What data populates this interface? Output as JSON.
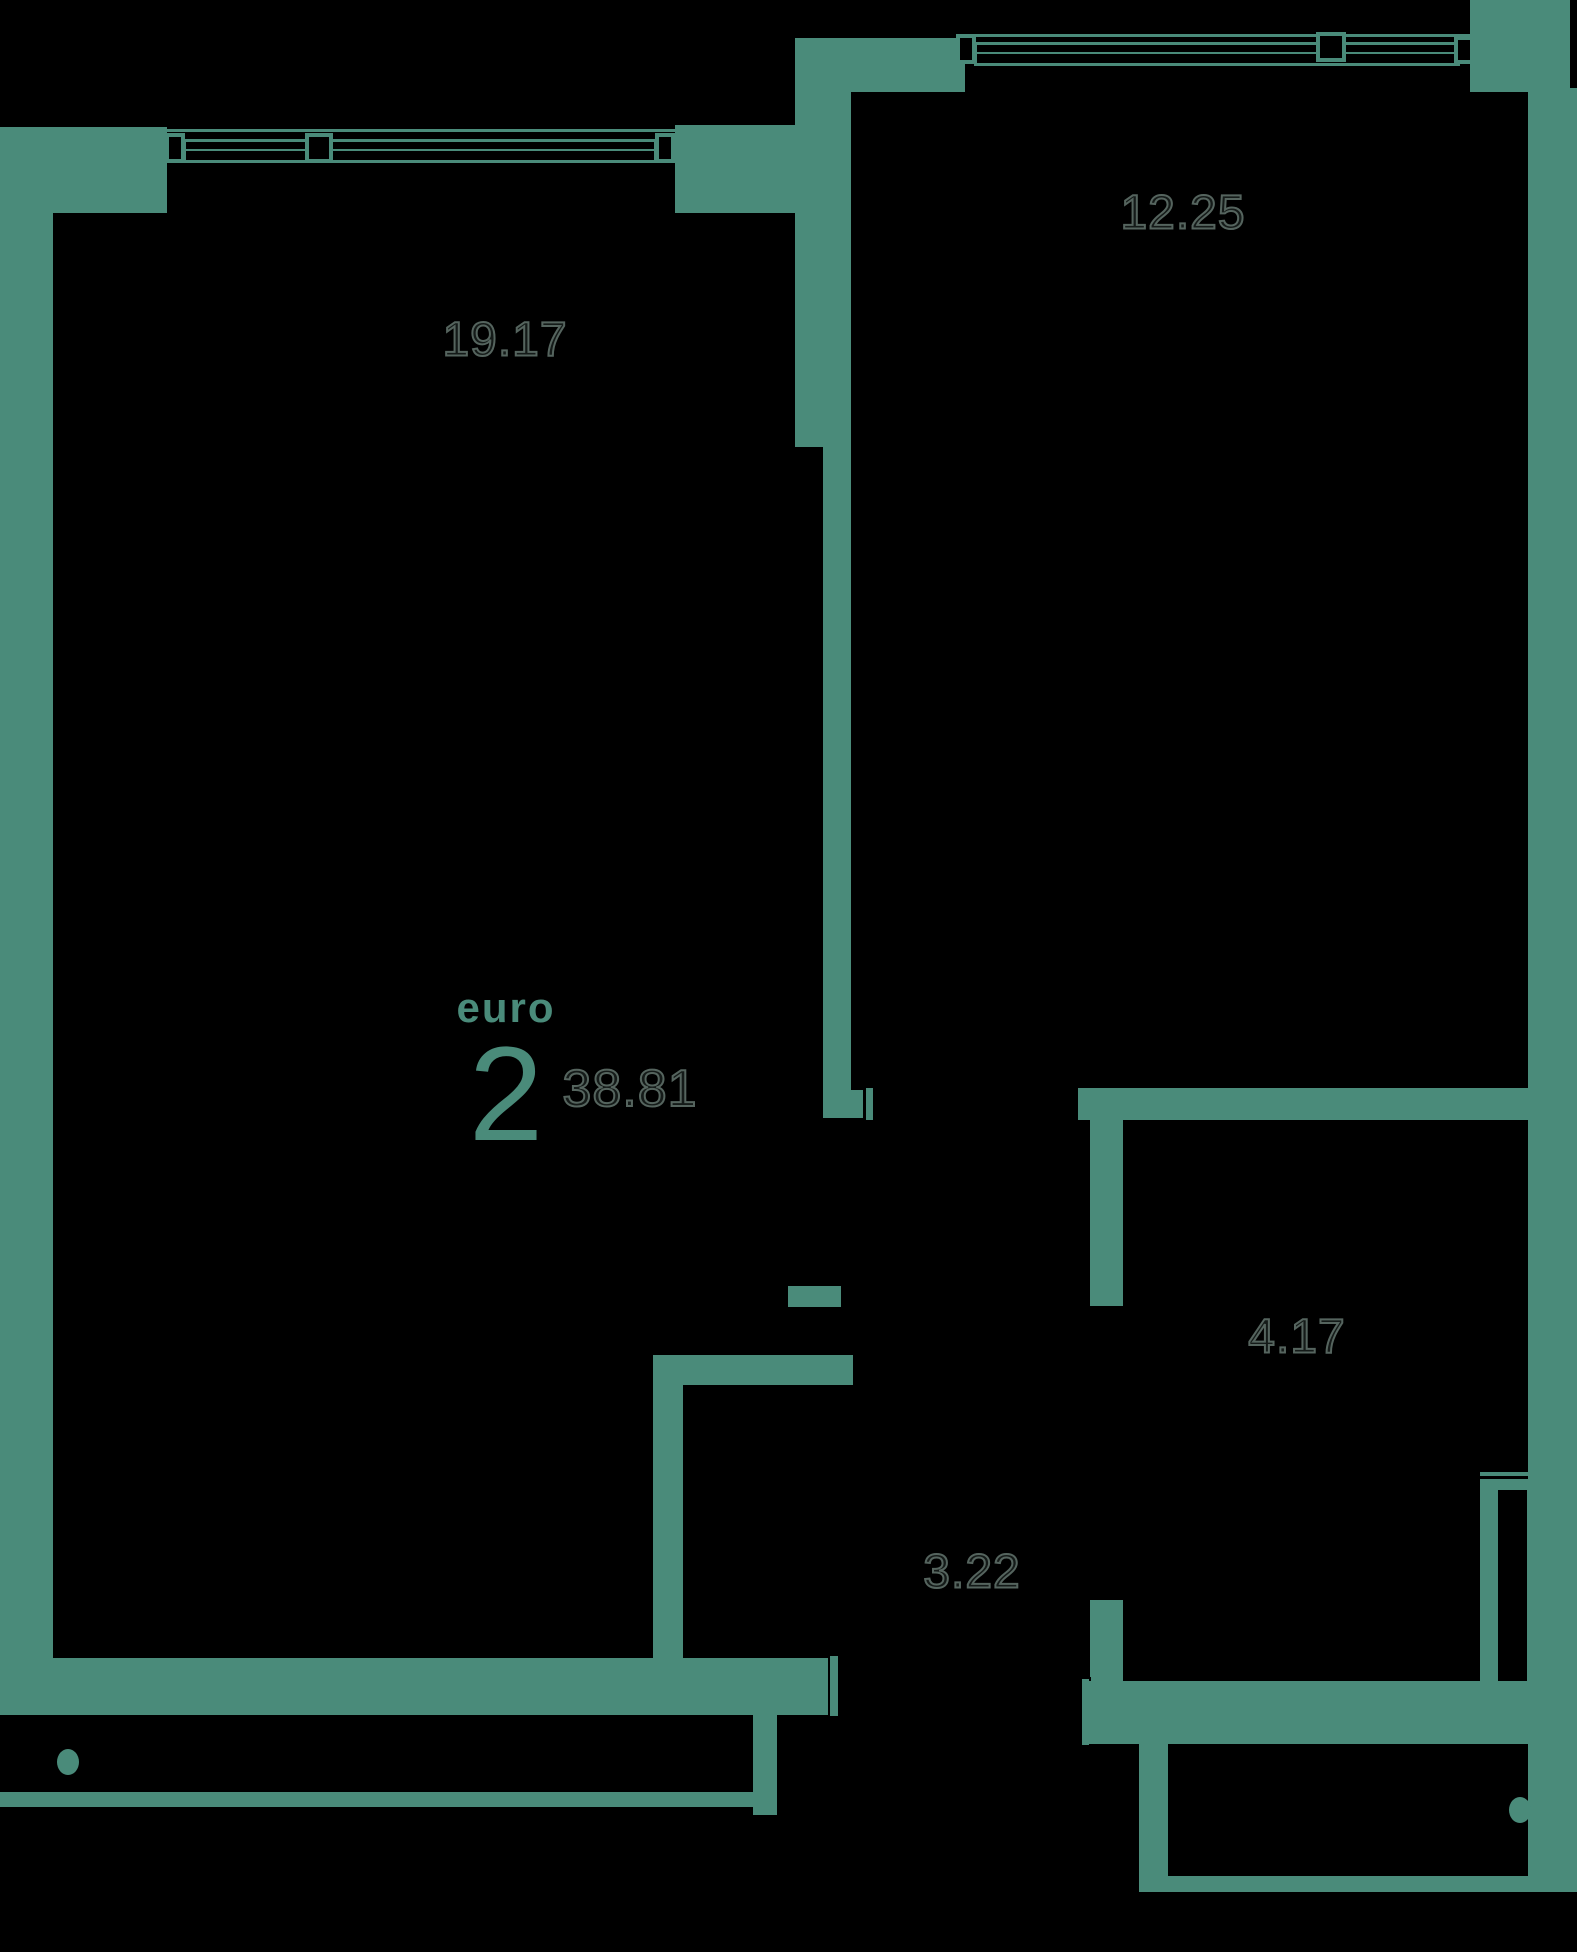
{
  "plan": {
    "colors": {
      "background": "#000000",
      "wall": "#4a8b7a",
      "label_outline": "#55645e",
      "accent": "#4a8b7a"
    },
    "rooms": [
      {
        "id": "living-room",
        "area": "19.17"
      },
      {
        "id": "bedroom",
        "area": "12.25"
      },
      {
        "id": "bathroom",
        "area": "4.17"
      },
      {
        "id": "hallway",
        "area": "3.22"
      }
    ],
    "apartment_badge": {
      "type": "euro",
      "room_count": "2",
      "total_area": "38.81"
    }
  }
}
